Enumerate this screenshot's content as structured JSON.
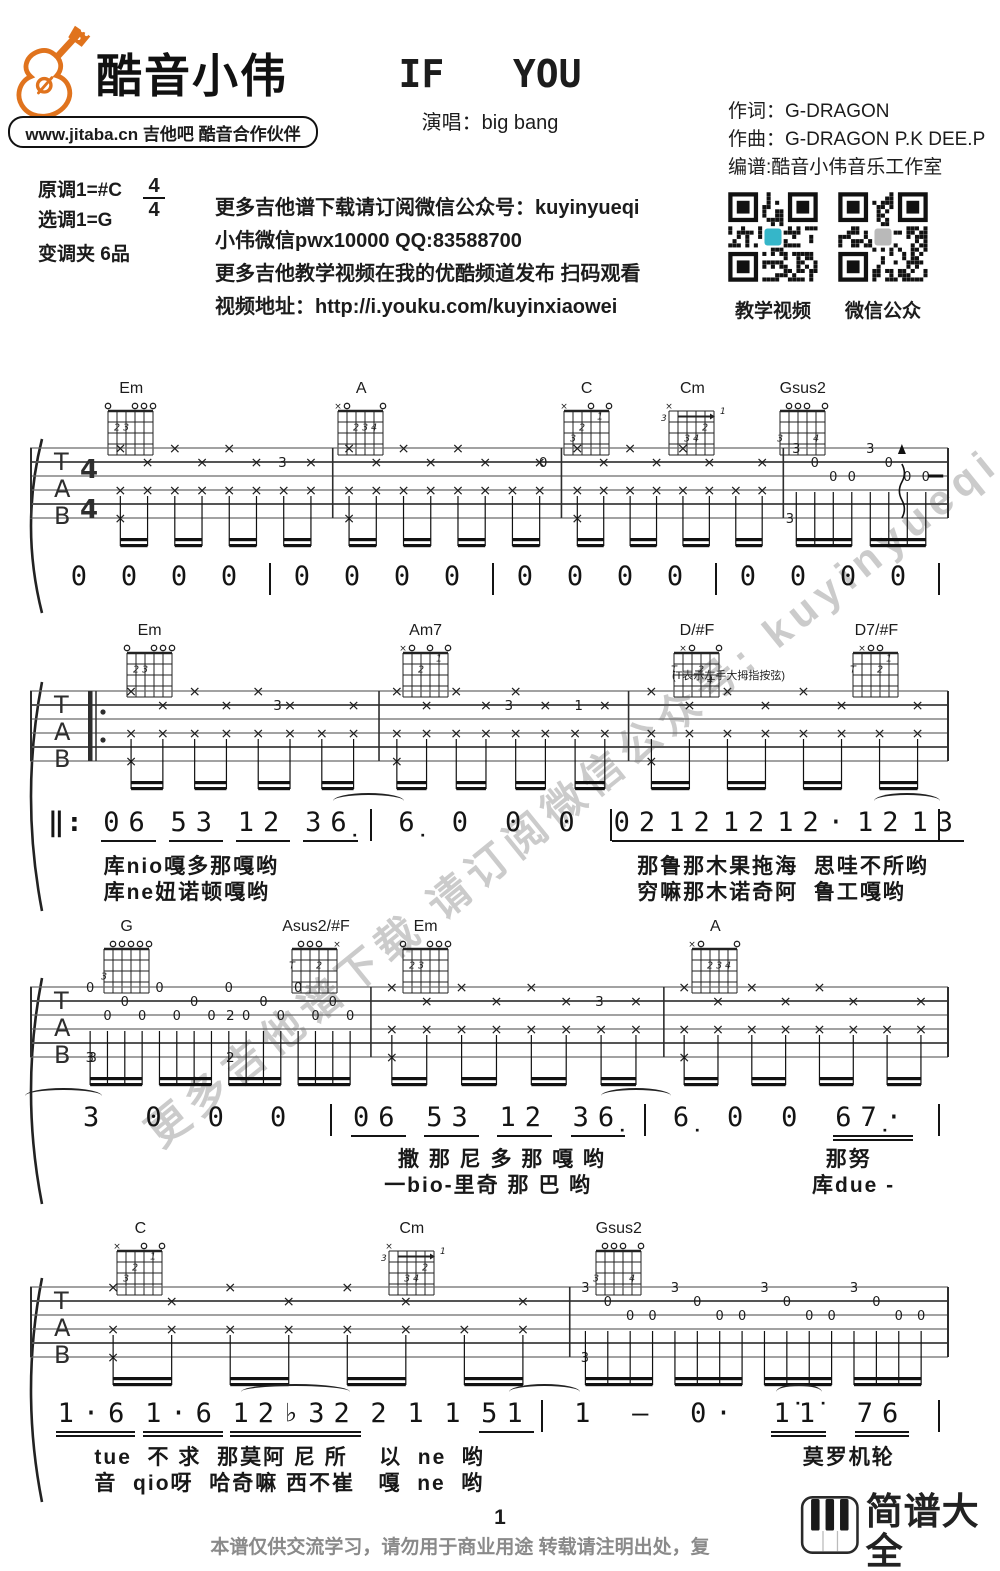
{
  "header": {
    "logo_text": "酷音小伟",
    "logo_sub": "www.jitaba.cn 吉他吧 酷音合作伙伴",
    "title": "IF   YOU",
    "singer_label": "演唱：big bang",
    "credits": [
      "作词：G-DRAGON",
      "作曲：G-DRAGON P.K DEE.P",
      "编谱:酷音小伟音乐工作室"
    ]
  },
  "info": {
    "key_original": "原调1=#C",
    "time_num": "4",
    "time_den": "4",
    "key_play": "选调1=G",
    "capo": "变调夹 6品",
    "promo_lines": [
      "更多吉他谱下载请订阅微信公众号：kuyinyueqi",
      "小伟微信pwx10000 QQ:83588700",
      "更多吉他教学视频在我的优酷频道发布 扫码观看",
      "视频地址：http://i.youku.com/kuyinxiaowei"
    ],
    "qr_codes": [
      {
        "label": "教学视频",
        "center_color": "#35b6c9"
      },
      {
        "label": "微信公众",
        "center_color": "#b9b9b9"
      }
    ]
  },
  "watermark": "更多吉他谱下载 请订阅微信公众号: kuyinyueqi",
  "thumb_note": "(T表示左手大拇指按弦)",
  "chord_shapes": {
    "Em": {
      "open": [
        6,
        3,
        2,
        1
      ],
      "mute": [],
      "fingers": [
        [
          5,
          2,
          "2"
        ],
        [
          4,
          2,
          "3"
        ]
      ]
    },
    "A": {
      "open": [
        5,
        1
      ],
      "mute": [
        6
      ],
      "fingers": [
        [
          4,
          2,
          "2"
        ],
        [
          3,
          2,
          "3"
        ],
        [
          2,
          2,
          "4"
        ]
      ]
    },
    "C": {
      "open": [
        3,
        1
      ],
      "mute": [
        6
      ],
      "fingers": [
        [
          2,
          1,
          "1"
        ],
        [
          4,
          2,
          "2"
        ],
        [
          5,
          3,
          "3"
        ]
      ]
    },
    "Cm": {
      "open": [],
      "mute": [
        6
      ],
      "base": "3",
      "barre": true,
      "fingers": [
        [
          2,
          2,
          "2"
        ],
        [
          4,
          3,
          "3"
        ],
        [
          3,
          3,
          "4"
        ]
      ]
    },
    "Gsus2": {
      "open": [
        5,
        4,
        3,
        1
      ],
      "mute": [],
      "fingers": [
        [
          6,
          3,
          "3"
        ],
        [
          2,
          3,
          "4"
        ]
      ]
    },
    "Am7": {
      "open": [
        5,
        3,
        1
      ],
      "mute": [
        6
      ],
      "fingers": [
        [
          2,
          1,
          "1"
        ],
        [
          4,
          2,
          "2"
        ]
      ]
    },
    "D/#F": {
      "open": [
        4,
        1
      ],
      "mute": [
        5
      ],
      "fingers": [
        [
          6,
          2,
          "T"
        ],
        [
          3,
          2,
          "2"
        ],
        [
          2,
          3,
          "4"
        ]
      ]
    },
    "D7/#F": {
      "open": [
        4,
        3
      ],
      "mute": [
        5
      ],
      "fingers": [
        [
          6,
          2,
          "T"
        ],
        [
          3,
          2,
          "2"
        ],
        [
          2,
          1,
          "1"
        ]
      ]
    },
    "G": {
      "open": [
        5,
        4,
        3,
        2,
        1
      ],
      "mute": [],
      "fingers": [
        [
          6,
          3,
          "3"
        ]
      ]
    },
    "Asus2/#F": {
      "open": [
        5,
        4,
        3
      ],
      "mute": [
        1
      ],
      "fingers": [
        [
          6,
          2,
          "T"
        ],
        [
          3,
          2,
          "2"
        ]
      ]
    }
  },
  "systems": [
    {
      "chords": [
        {
          "name": "Em",
          "x": 11
        },
        {
          "name": "A",
          "x": 36
        },
        {
          "name": "C",
          "x": 60.5
        },
        {
          "name": "Cm",
          "x": 72
        },
        {
          "name": "Gsus2",
          "x": 84
        }
      ],
      "staff": {
        "timeSig": true,
        "repeatStart": false,
        "measures": [
          {
            "w": 1.0,
            "pat": "strum",
            "ann": [
              {
                "s": 2,
                "p": 0.78,
                "t": "3"
              }
            ]
          },
          {
            "w": 1.0,
            "pat": "strum",
            "ann": [
              {
                "s": 2,
                "p": 0.92,
                "t": "0"
              }
            ]
          },
          {
            "w": 0.97,
            "pat": "strum",
            "ann": []
          },
          {
            "w": 0.72,
            "pat": "arp",
            "beats": 2,
            "bass": "3",
            "top": "3",
            "ann": [
              {
                "type": "arrow",
                "p": 0.72
              },
              {
                "type": "dash",
                "p": 0.88
              }
            ]
          }
        ]
      },
      "melody": {
        "repeatStart": false,
        "endBar": true,
        "measures": [
          {
            "w": 1,
            "g": [
              {
                "n": "0"
              },
              {
                "n": "0"
              },
              {
                "n": "0"
              },
              {
                "n": "0"
              }
            ]
          },
          {
            "w": 1,
            "g": [
              {
                "n": "0"
              },
              {
                "n": "0"
              },
              {
                "n": "0"
              },
              {
                "n": "0"
              }
            ]
          },
          {
            "w": 1,
            "g": [
              {
                "n": "0"
              },
              {
                "n": "0"
              },
              {
                "n": "0"
              },
              {
                "n": "0"
              }
            ]
          },
          {
            "w": 1,
            "g": [
              {
                "n": "0"
              },
              {
                "n": "0"
              },
              {
                "n": "0"
              },
              {
                "n": "0"
              }
            ]
          }
        ]
      },
      "lyrics": []
    },
    {
      "chords": [
        {
          "name": "Em",
          "x": 13
        },
        {
          "name": "Am7",
          "x": 43
        },
        {
          "name": "D/#F",
          "x": 72.5
        },
        {
          "name": "D7/#F",
          "x": 92
        }
      ],
      "thumb_note": true,
      "staff": {
        "timeSig": false,
        "repeatStart": true,
        "measures": [
          {
            "w": 1.07,
            "pat": "strum",
            "ann": [
              {
                "s": 2,
                "p": 0.62,
                "t": "3"
              }
            ]
          },
          {
            "w": 1.0,
            "pat": "strum",
            "ann": [
              {
                "s": 2,
                "p": 0.52,
                "t": "3"
              },
              {
                "s": 2,
                "p": 0.8,
                "t": "1"
              }
            ]
          },
          {
            "w": 1.28,
            "pat": "strum",
            "ann": []
          }
        ]
      },
      "melody": {
        "repeatStart": true,
        "endBar": true,
        "measures": [
          {
            "w": 1.9,
            "g": [
              {
                "n": "06",
                "u": 1
              },
              {
                "n": "53",
                "u": 1
              },
              {
                "n": "12",
                "u": 1
              },
              {
                "n": "36̣",
                "u": 1,
                "tie": "fwd"
              }
            ]
          },
          {
            "w": 1.6,
            "g": [
              {
                "n": "6̣"
              },
              {
                "n": "0"
              },
              {
                "n": "0"
              },
              {
                "n": "0"
              }
            ]
          },
          {
            "w": 2.2,
            "g": [
              {
                "n": "02",
                "u": 1
              },
              {
                "n": "12",
                "u": 1
              },
              {
                "n": "12",
                "u": 1
              },
              {
                "n": "12·",
                "u": 1
              },
              {
                "n": "12",
                "u": 1
              },
              {
                "n": "13",
                "u": 1,
                "tie": "back"
              }
            ]
          }
        ]
      },
      "lyrics": [
        [
          {
            "x": 8,
            "t": "库nio嘎多那嘎哟"
          },
          {
            "x": 66,
            "t": "那鲁那木果拖海  思哇不所哟"
          }
        ],
        [
          {
            "x": 8,
            "t": "库ne妞诺顿嘎哟"
          },
          {
            "x": 66,
            "t": "穷嘛那木诺奇阿  鲁工嘎哟"
          }
        ]
      ]
    },
    {
      "chords": [
        {
          "name": "G",
          "x": 10.5
        },
        {
          "name": "Asus2/#F",
          "x": 31
        },
        {
          "name": "Em",
          "x": 43
        },
        {
          "name": "A",
          "x": 74.5
        }
      ],
      "staff": {
        "timeSig": false,
        "repeatStart": false,
        "measures": [
          {
            "w": 1.0,
            "pat": "pick",
            "ann": [
              {
                "s": 6,
                "p": 0.05,
                "t": "3"
              },
              {
                "s": 3,
                "p": 0.52,
                "t": "2"
              },
              {
                "s": 6,
                "p": 0.52,
                "t": "2"
              }
            ]
          },
          {
            "w": 1.0,
            "pat": "strum",
            "ann": [
              {
                "s": 2,
                "p": 0.78,
                "t": "3"
              }
            ]
          },
          {
            "w": 0.97,
            "pat": "strum",
            "ann": []
          }
        ]
      },
      "melody": {
        "repeatStart": false,
        "endBar": true,
        "measures": [
          {
            "w": 1.45,
            "g": [
              {
                "n": "3",
                "tie": "backwide"
              },
              {
                "n": "0"
              },
              {
                "n": "0"
              },
              {
                "n": "0"
              }
            ]
          },
          {
            "w": 1.6,
            "g": [
              {
                "n": "06",
                "u": 1
              },
              {
                "n": "53",
                "u": 1
              },
              {
                "n": "12",
                "u": 1
              },
              {
                "n": "36̣",
                "u": 1,
                "tie": "fwd"
              }
            ]
          },
          {
            "w": 1.5,
            "g": [
              {
                "n": "6̣"
              },
              {
                "n": "0"
              },
              {
                "n": "0"
              },
              {
                "n": "67̣·",
                "u": 2
              }
            ]
          }
        ]
      },
      "lyrics": [
        [
          {
            "x": 40,
            "t": "撒 那 尼 多 那 嘎 哟"
          },
          {
            "x": 86.5,
            "t": "那努"
          }
        ],
        [
          {
            "x": 38.5,
            "t": "一bio-里奇 那 巴 哟"
          },
          {
            "x": 85,
            "t": "库due -"
          }
        ]
      ]
    },
    {
      "chords": [
        {
          "name": "C",
          "x": 12
        },
        {
          "name": "Cm",
          "x": 41.5
        },
        {
          "name": "Gsus2",
          "x": 64
        }
      ],
      "staff": {
        "timeSig": false,
        "repeatStart": false,
        "measures": [
          {
            "w": 1.3,
            "pat": "strum",
            "ann": []
          },
          {
            "w": 1.0,
            "pat": "arp",
            "beats": 4,
            "bass": "3",
            "top": "3",
            "ann": []
          }
        ]
      },
      "melody": {
        "repeatStart": false,
        "endBar": true,
        "measures": [
          {
            "w": 2.5,
            "g": [
              {
                "n": "1·6",
                "u": 2
              },
              {
                "n": "1·6",
                "u": 2
              },
              {
                "n": "12♭32",
                "u": 2,
                "tie": "self"
              },
              {
                "n": "2"
              },
              {
                "n": "1"
              },
              {
                "n": "1"
              },
              {
                "n": "51",
                "u": 1,
                "tie": "fwd"
              }
            ]
          },
          {
            "w": 2.0,
            "g": [
              {
                "n": "1"
              },
              {
                "n": "—"
              },
              {
                "n": "0·"
              },
              {
                "n": "1̇1̇",
                "u": 2,
                "tie": "self"
              },
              {
                "n": "76",
                "u": 2
              }
            ]
          }
        ]
      },
      "lyrics": [
        [
          {
            "x": 7,
            "t": "tue  不 求  那莫阿 尼 所    以  ne  哟"
          },
          {
            "x": 84,
            "t": "莫罗机轮"
          }
        ],
        [
          {
            "x": 7,
            "t": "音  qio呀  哈奇嘛 西不崔   嘎  ne  哟"
          }
        ]
      ]
    }
  ],
  "footer": {
    "page_number": "1",
    "disclaimer": "本谱仅供交流学习，请勿用于商业用途 转载请注明出处，复",
    "brand": "简谱大全",
    "brand_url": "jianpudq.com"
  }
}
